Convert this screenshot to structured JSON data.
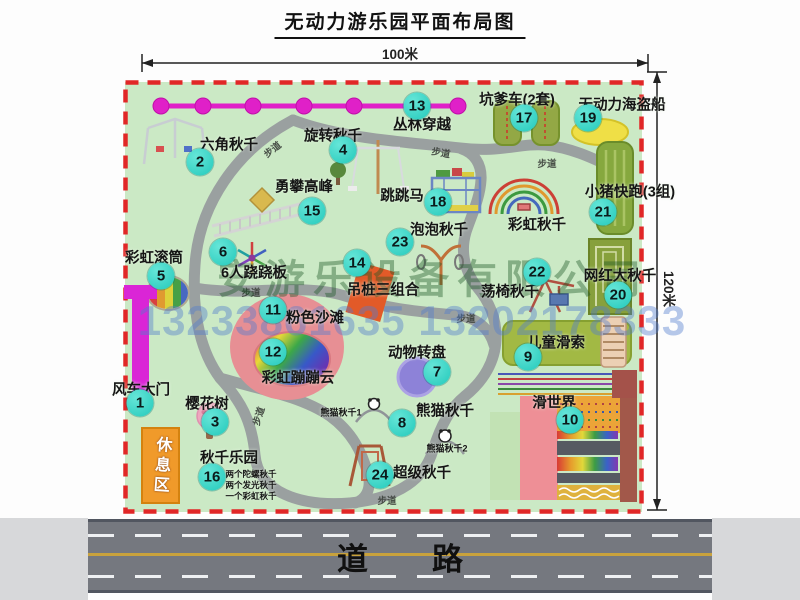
{
  "title": "无动力游乐园平面布局图",
  "dimensions": {
    "width_label": "100米",
    "height_label": "120米"
  },
  "road": {
    "label": "道路"
  },
  "watermark": {
    "company": "安游乐设备有限公司",
    "phone": "13233861635 13202178333"
  },
  "rest_area": {
    "label": "休息区"
  },
  "map": {
    "attractions": [
      {
        "num": 1,
        "label": "风车大门",
        "lx": 141,
        "ly": 389,
        "bx": 140,
        "by": 403
      },
      {
        "num": 2,
        "label": "六角秋千",
        "lx": 229,
        "ly": 144,
        "bx": 200,
        "by": 162
      },
      {
        "num": 3,
        "label": "樱花树",
        "lx": 207,
        "ly": 403,
        "bx": 215,
        "by": 422
      },
      {
        "num": 4,
        "label": "旋转秋千",
        "lx": 333,
        "ly": 135,
        "bx": 343,
        "by": 150
      },
      {
        "num": 5,
        "label": "彩虹滚筒",
        "lx": 154,
        "ly": 257,
        "bx": 161,
        "by": 276
      },
      {
        "num": 6,
        "label": "6人跷跷板",
        "lx": 254,
        "ly": 272,
        "bx": 223,
        "by": 252
      },
      {
        "num": 7,
        "label": "动物转盘",
        "lx": 417,
        "ly": 352,
        "bx": 437,
        "by": 372
      },
      {
        "num": 8,
        "label": "熊猫秋千",
        "lx": 445,
        "ly": 410,
        "bx": 402,
        "by": 423
      },
      {
        "num": 9,
        "label": "儿童滑索",
        "lx": 556,
        "ly": 342,
        "bx": 528,
        "by": 357
      },
      {
        "num": 10,
        "label": "滑世界",
        "lx": 554,
        "ly": 402,
        "bx": 570,
        "by": 420
      },
      {
        "num": 11,
        "label": "粉色沙滩",
        "lx": 315,
        "ly": 317,
        "bx": 273,
        "by": 310
      },
      {
        "num": 12,
        "label": "彩虹蹦蹦云",
        "lx": 298,
        "ly": 377,
        "bx": 273,
        "by": 352
      },
      {
        "num": 13,
        "label": "丛林穿越",
        "lx": 422,
        "ly": 124,
        "bx": 417,
        "by": 106
      },
      {
        "num": 14,
        "label": "吊桩三组合",
        "lx": 383,
        "ly": 289,
        "bx": 357,
        "by": 263
      },
      {
        "num": 15,
        "label": "勇攀高峰",
        "lx": 304,
        "ly": 186,
        "bx": 312,
        "by": 211
      },
      {
        "num": 16,
        "label": "秋千乐园",
        "lx": 229,
        "ly": 457,
        "bx": 212,
        "by": 477
      },
      {
        "num": 17,
        "label": "坑爹车(2套)",
        "lx": 517,
        "ly": 99,
        "bx": 524,
        "by": 118
      },
      {
        "num": 18,
        "label": "跳跳马",
        "lx": 402,
        "ly": 195,
        "bx": 438,
        "by": 202
      },
      {
        "num": 19,
        "label": "无动力海盗船",
        "lx": 622,
        "ly": 104,
        "bx": 588,
        "by": 118
      },
      {
        "num": 20,
        "label": "网红大秋千",
        "lx": 620,
        "ly": 275,
        "bx": 618,
        "by": 295
      },
      {
        "num": 21,
        "label": "小猪快跑(3组)",
        "lx": 630,
        "ly": 191,
        "bx": 603,
        "by": 212
      },
      {
        "num": 22,
        "label": "荡椅秋千",
        "lx": 510,
        "ly": 291,
        "bx": 537,
        "by": 272
      },
      {
        "num": 23,
        "label": "泡泡秋千",
        "lx": 439,
        "ly": 229,
        "bx": 400,
        "by": 242
      },
      {
        "num": 24,
        "label": "超级秋千",
        "lx": 422,
        "ly": 472,
        "bx": 380,
        "by": 475
      }
    ],
    "small_labels": [
      {
        "text": "彩虹秋千",
        "x": 537,
        "y": 224,
        "size": 14.5
      },
      {
        "text": "熊猫秋千1",
        "x": 341,
        "y": 412,
        "size": 9
      },
      {
        "text": "熊猫秋千2",
        "x": 447,
        "y": 448,
        "size": 9
      },
      {
        "text": "两个陀螺秋千",
        "x": 251,
        "y": 474,
        "size": 8.5
      },
      {
        "text": "两个发光秋千",
        "x": 251,
        "y": 485,
        "size": 8.5
      },
      {
        "text": "一个彩虹秋千",
        "x": 251,
        "y": 496,
        "size": 8.5
      }
    ],
    "path_labels": [
      {
        "text": "步道",
        "x": 272,
        "y": 149,
        "r": -38
      },
      {
        "text": "步道",
        "x": 441,
        "y": 152,
        "r": 10
      },
      {
        "text": "步道",
        "x": 547,
        "y": 163,
        "r": 0
      },
      {
        "text": "步道",
        "x": 251,
        "y": 292,
        "r": 0
      },
      {
        "text": "步道",
        "x": 466,
        "y": 318,
        "r": 0
      },
      {
        "text": "步道",
        "x": 258,
        "y": 416,
        "r": -72
      },
      {
        "text": "步道",
        "x": 387,
        "y": 500,
        "r": 0
      }
    ]
  }
}
